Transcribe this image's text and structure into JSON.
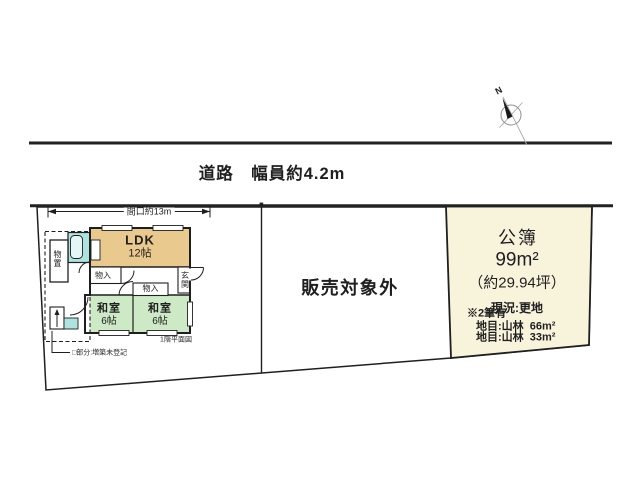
{
  "road": {
    "label": "道路　幅員約4.2m"
  },
  "compass": {
    "north_label": "N"
  },
  "site": {
    "frontage_label": "間口約13m",
    "not_for_sale_label": "販売対象外"
  },
  "floor_plan": {
    "ldk_name": "LDK",
    "ldk_size": "12帖",
    "closet_a_label": "物入",
    "closet_b_label": "物入",
    "entrance_label": "玄関",
    "storage_label": "物置",
    "washitsu_left_name": "和室",
    "washitsu_left_size": "6帖",
    "washitsu_right_name": "和室",
    "washitsu_right_size": "6帖",
    "caption": "1階平面図",
    "extension_note": "□部分:増築未登記"
  },
  "parcel": {
    "register_label": "公簿",
    "area_label": "99m²",
    "tsubo_label": "（約29.94坪）",
    "status_label": "現況:更地",
    "note_heading": "※2筆有",
    "note_line1": "地目:山林  66m²",
    "note_line2": "地目:山林  33m²"
  },
  "colors": {
    "line": "#1f1f1f",
    "ldk_fill": "#eac98f",
    "tatami_fill": "#cde9c5",
    "bath_fill": "#aee4e0",
    "tub_fill": "#e4f6f5",
    "parcel_fill": "#f8f4dc"
  }
}
